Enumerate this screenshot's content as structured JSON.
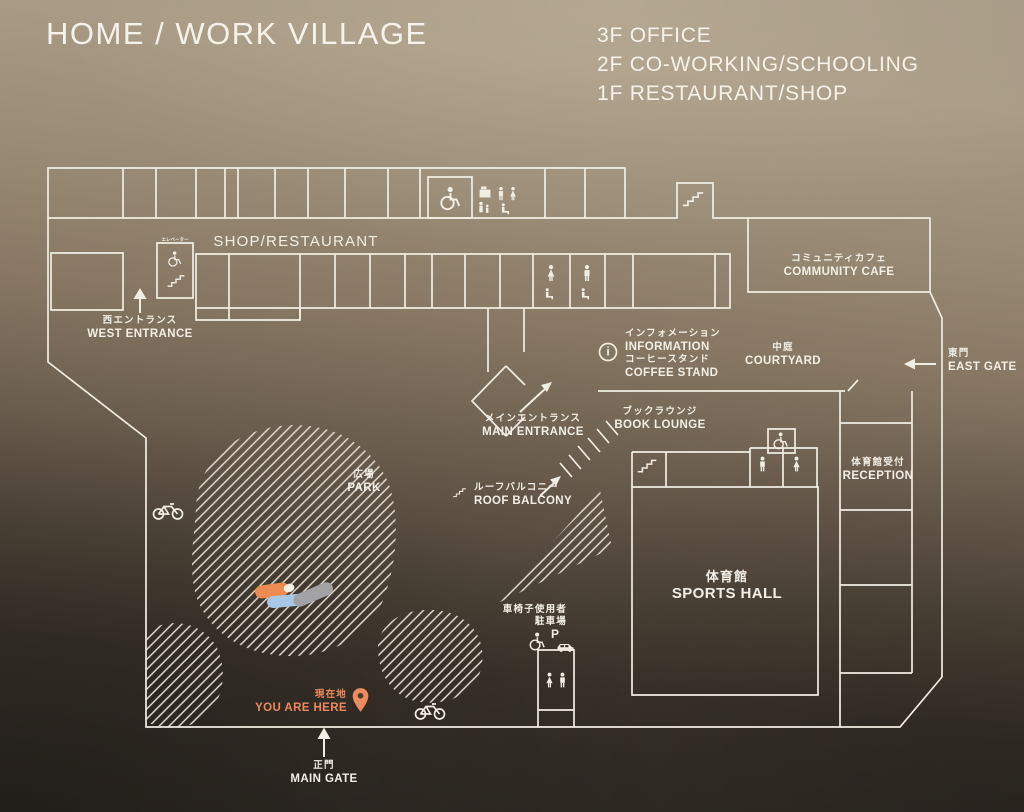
{
  "sign": {
    "title": "HOME / WORK VILLAGE",
    "floors": [
      "3F OFFICE",
      "2F CO-WORKING/SCHOOLING",
      "1F RESTAURANT/SHOP"
    ]
  },
  "labels": {
    "shop_restaurant": {
      "en": "SHOP/RESTAURANT"
    },
    "west_entrance": {
      "jp": "西エントランス",
      "en": "WEST ENTRANCE"
    },
    "elevator": {
      "jp": "エレベーター"
    },
    "community_cafe": {
      "jp": "コミュニティカフェ",
      "en": "COMMUNITY CAFE"
    },
    "information": {
      "jp": "インフォメーション",
      "en": "INFORMATION",
      "i": "i"
    },
    "coffee_stand": {
      "jp": "コーヒースタンド",
      "en": "COFFEE STAND"
    },
    "courtyard": {
      "jp": "中庭",
      "en": "COURTYARD"
    },
    "east_gate": {
      "jp": "東門",
      "en": "EAST GATE"
    },
    "main_entrance": {
      "jp": "メインエントランス",
      "en": "MAIN ENTRANCE"
    },
    "book_lounge": {
      "jp": "ブックラウンジ",
      "en": "BOOK LOUNGE"
    },
    "reception": {
      "jp": "体育館受付",
      "en": "RECEPTION"
    },
    "park": {
      "jp": "広場",
      "en": "PARK"
    },
    "roof_balcony": {
      "jp": "ルーフバルコニー",
      "en": "ROOF BALCONY"
    },
    "sports_hall": {
      "jp": "体育館",
      "en": "SPORTS HALL"
    },
    "accessible_parking": {
      "jp_line1": "車椅子使用者",
      "jp_line2": "駐車場",
      "p": "P"
    },
    "you_are_here": {
      "jp": "現在地",
      "en": "YOU ARE HERE"
    },
    "main_gate": {
      "jp": "正門",
      "en": "MAIN GATE"
    }
  },
  "colors": {
    "line": "#F2EDE3",
    "accent_orange": "#ED8A5F",
    "pill_orange": "#ED8C52",
    "pill_blue": "#A9C7E6",
    "pill_gray": "#A2A2A4",
    "pill_white": "#F5F1E8"
  },
  "icons": [
    "wheelchair-icon",
    "restroom-man-icon",
    "restroom-woman-icon",
    "baby-care-icon",
    "parent-child-icon",
    "bench-seat-icon",
    "stairs-icon",
    "information-icon",
    "bicycle-icon",
    "parking-p-icon",
    "car-icon",
    "map-pin-icon",
    "arrow-up-icon",
    "arrow-left-icon",
    "arrow-ne-icon"
  ]
}
